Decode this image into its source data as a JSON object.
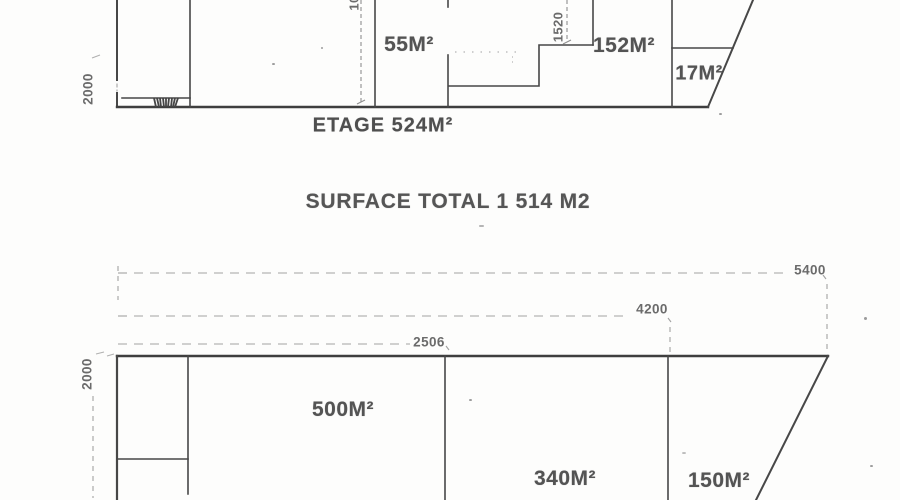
{
  "palette": {
    "ink": "#474747",
    "heavy_ink": "#3e3e3e",
    "dimension_gray": "#a2a2a2",
    "text_gray": "#545454",
    "paper": "#fdfdfc"
  },
  "upper_plan": {
    "caption": "ETAGE 524M²",
    "rooms": [
      {
        "label": "55M²"
      },
      {
        "label": "152M²"
      },
      {
        "label": "17M²"
      }
    ],
    "dims": {
      "left_height": "2000",
      "step_width": "1520",
      "clipped_top": "10"
    }
  },
  "summary": {
    "title": "SURFACE TOTAL 1 514 M2"
  },
  "lower_plan": {
    "rooms": [
      {
        "label": "500M²"
      },
      {
        "label": "340M²"
      },
      {
        "label": "150M²"
      }
    ],
    "dims": {
      "width_inner": "2506",
      "width_middle": "4200",
      "width_outer": "5400",
      "left_height": "2000"
    }
  }
}
